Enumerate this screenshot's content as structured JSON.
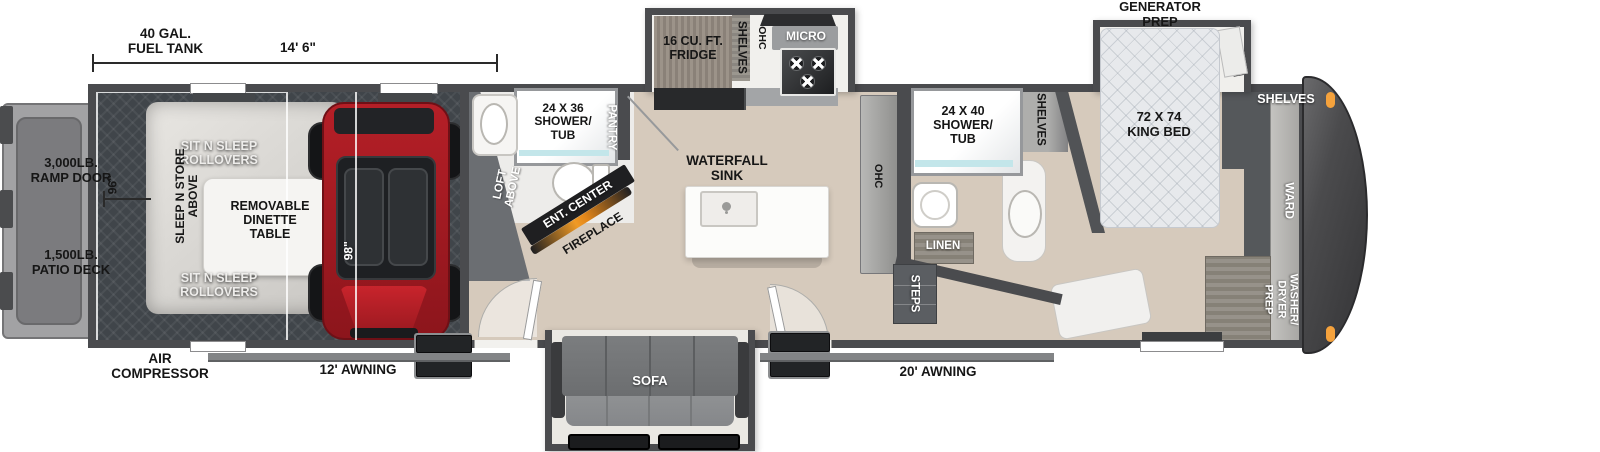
{
  "annotations": {
    "fuel_tank": "40 GAL.\nFUEL TANK",
    "length": "14' 6\"",
    "generator_prep": "GENERATOR\nPREP",
    "air_compressor": "AIR\nCOMPRESSOR",
    "awning_left": "12' AWNING",
    "awning_right": "20' AWNING",
    "ramp_door": "3,000LB.\nRAMP DOOR",
    "patio_deck": "1,500LB.\nPATIO DECK",
    "dim_96": "96\"",
    "dim_98": "98\""
  },
  "garage": {
    "sit_n_sleep_top": "SIT N SLEEP\nROLLOVERS",
    "sit_n_sleep_bottom": "SIT N SLEEP\nROLLOVERS",
    "sleep_n_store": "SLEEP N STORE\nABOVE",
    "dinette": "REMOVABLE\nDINETTE\nTABLE",
    "loft": "LOFT\nABOVE"
  },
  "bath_mid": {
    "shower": "24 X 36\nSHOWER/\nTUB",
    "pantry": "PANTRY"
  },
  "media_wall": {
    "ent_center": "ENT. CENTER",
    "fireplace": "FIREPLACE"
  },
  "kitchen": {
    "fridge": "16 CU. FT.\nFRIDGE",
    "shelves": "SHELVES",
    "ohc": "OHC",
    "micro": "MICRO",
    "island": "WATERFALL\nSINK"
  },
  "hallway": {
    "ohc": "OHC",
    "steps": "STEPS"
  },
  "bath_front": {
    "shower": "24 X 40\nSHOWER/\nTUB",
    "shelves": "SHELVES",
    "linen": "LINEN"
  },
  "bedroom": {
    "bed": "72 X 74\nKING BED",
    "shelves_front": "SHELVES",
    "ward": "WARD",
    "washer_dryer": "WASHER/\nDRYER\nPREP"
  },
  "living": {
    "sofa": "SOFA"
  },
  "colors": {
    "wall": "#4a4b4e",
    "wood_floor": "#d6cabc",
    "garage_floor": "#40454a",
    "accent_orange": "#f5a23c",
    "atv_red": "#b51f27"
  }
}
